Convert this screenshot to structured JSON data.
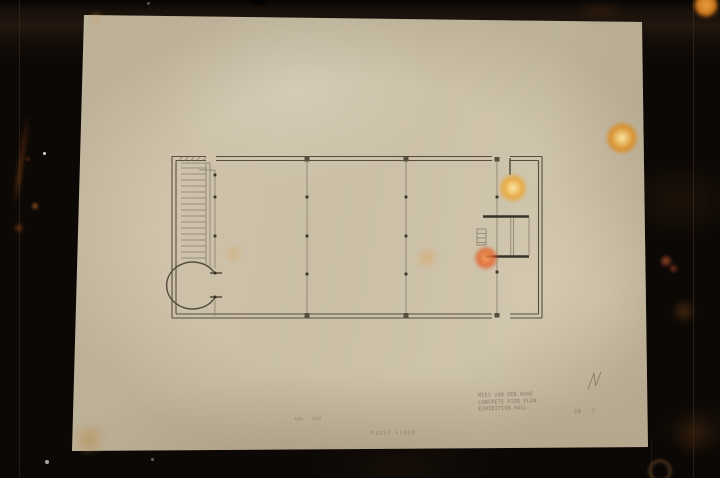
{
  "annotations": {
    "corner_block": {
      "line1": "MIES VAN DER ROHE",
      "line2": "CONCRETE PIER PLAN",
      "line3": "EXHIBITION HALL"
    },
    "sheet_number": "58 - 7",
    "dimension_note": "400 - 600",
    "floor_note": "FIRST  FLOOR"
  },
  "colors": {
    "background": "#0c0805",
    "paper": "#cbbfa6",
    "pencil": "#564e3f",
    "pencil-light": "#877d6b",
    "pencil-dark": "#37332b",
    "bokeh-warm": "#f3cf7f",
    "bokeh-orange": "#e05a25",
    "stain": "#b98b47"
  }
}
